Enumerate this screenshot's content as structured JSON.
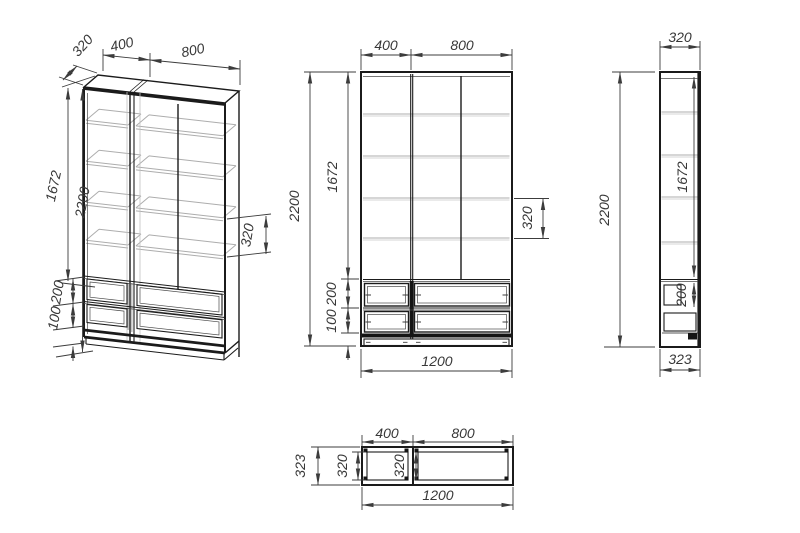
{
  "drawing_title": "wardrobe-technical-drawing",
  "palette": {
    "background": "#ffffff",
    "line": "#1b1b1b",
    "dimension": "#3c3c3c",
    "shelf": "#adadad"
  },
  "views": {
    "iso": {
      "label": "Isometric projection",
      "dims": {
        "depth": "320",
        "left_width": "400",
        "right_width": "800",
        "door_height": "1672",
        "total_height": "2200",
        "shelf_gap": "320",
        "drawer_row_height": "200",
        "bottom_drawer_height": "100"
      }
    },
    "front": {
      "label": "Front view",
      "dims": {
        "left_width": "400",
        "right_width": "800",
        "total_height": "2200",
        "door_height": "1672",
        "shelf_gap": "320",
        "drawer_row_height": "200",
        "bottom_drawer_height": "100",
        "total_width": "1200"
      }
    },
    "side": {
      "label": "Side view",
      "dims": {
        "depth": "320",
        "total_height": "2200",
        "door_height": "1672",
        "drawer_row_height": "200",
        "overall_depth": "323"
      }
    },
    "plan": {
      "label": "Top view",
      "dims": {
        "left_width": "400",
        "right_width": "800",
        "overall_depth": "323",
        "left_inner_depth": "320",
        "right_inner_depth": "320",
        "total_width": "1200"
      }
    }
  }
}
